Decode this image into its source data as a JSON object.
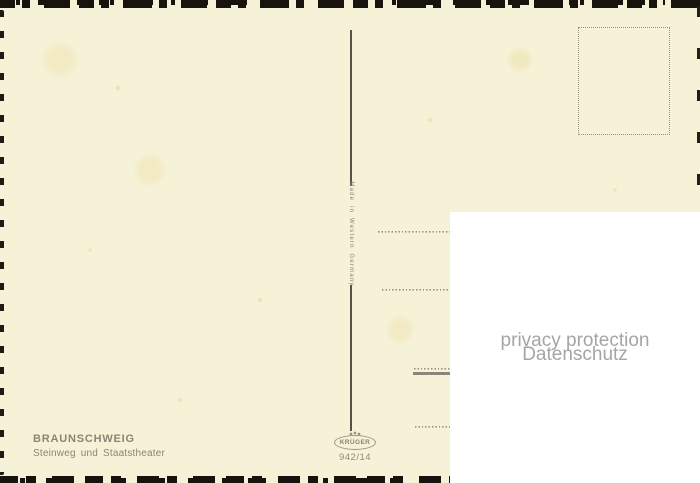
{
  "card": {
    "region": "BRAUNSCHWEIG",
    "caption": "Steinweg und Staatstheater",
    "made_in": "Made in Western Germany",
    "publisher": "KRÜGER",
    "number": "942/14"
  },
  "privacy": {
    "line1": "privacy protection",
    "line2": "Datenschutz"
  },
  "colors": {
    "card_background": "#f6f2d8",
    "ink": "#8b8574",
    "divider": "#55524b",
    "edge_marks": "#18130d",
    "dotted_lines": "#95907f",
    "overlay_background": "#ffffff",
    "overlay_text": "#a5a5a5"
  }
}
